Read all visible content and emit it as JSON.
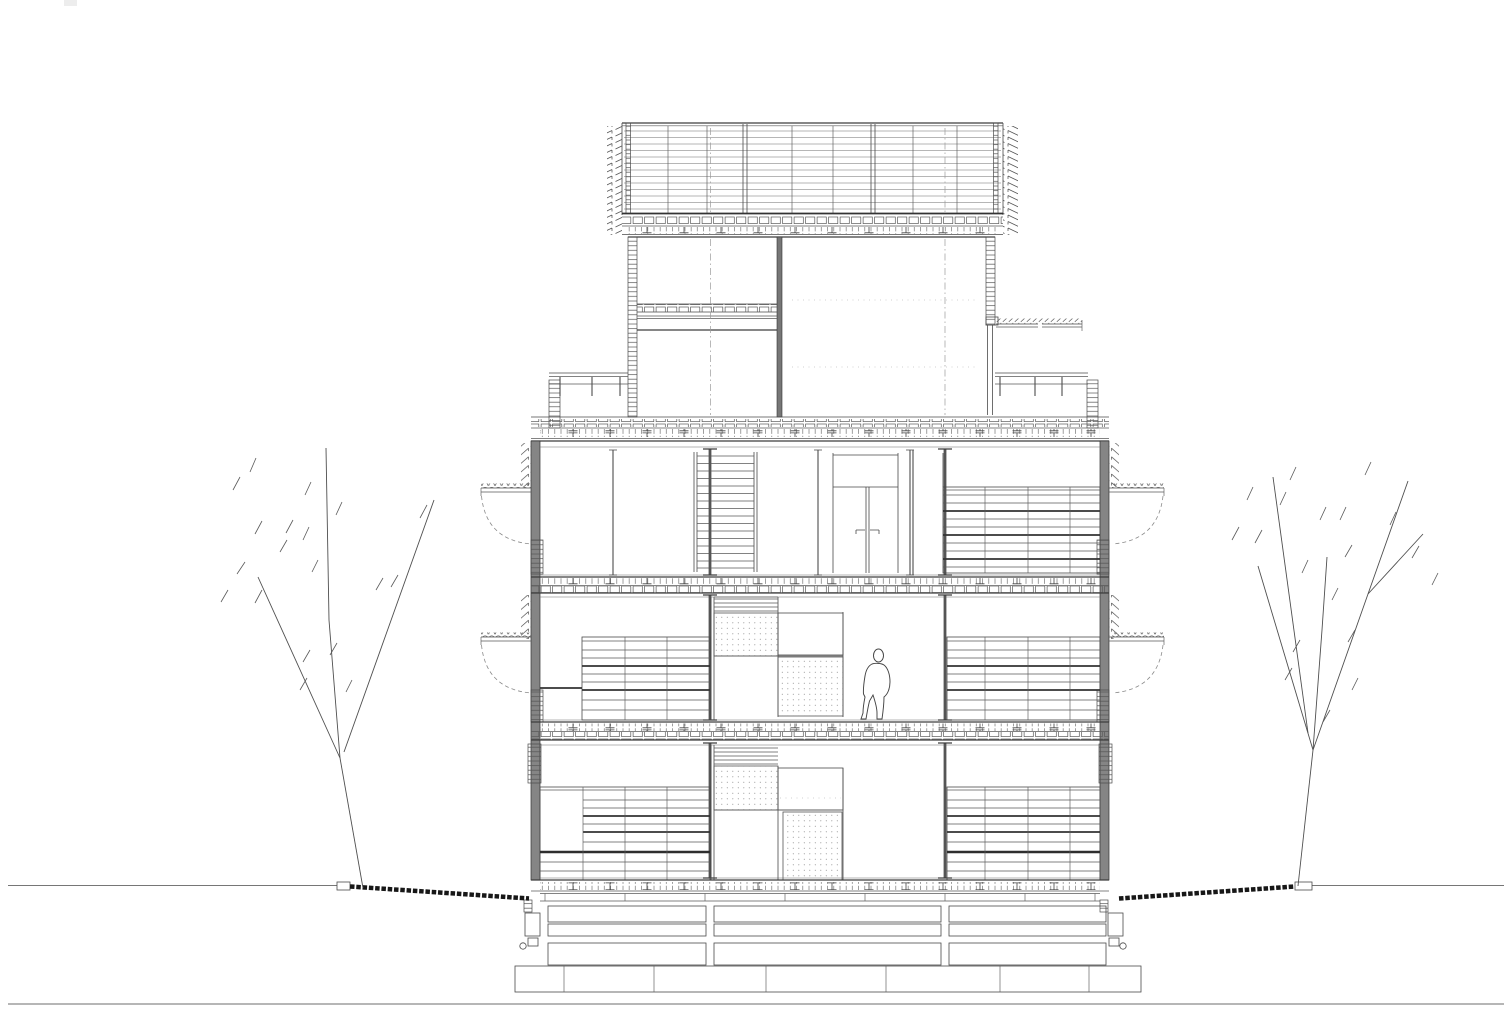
{
  "meta": {
    "title": "Building cross-section drawing",
    "description": "Black-and-white architectural cross-section of a multi-storey building: a louvered rooftop canopy above a set-back penthouse with roof terraces, three main floors with shelving grids, stairs, stippled insulation panels and a human scale figure, on a stepped foundation plinth, flanked by two bare trees on a ground line.",
    "canvas": {
      "width": 1512,
      "height": 1032
    },
    "background": "#ffffff"
  },
  "palette": {
    "line": "#4a4a4a",
    "line_light": "#6e6e6e",
    "wall_poche": "#858585",
    "ground_hatch": "#171717",
    "stipple_dot": "#8f8f8f",
    "centerline": "#9a9a9a"
  },
  "elements": {
    "canopy": "louvered rooftop canopy with slatted side fins",
    "penthouse": "penthouse level with window, blank wall and flanking roof terraces",
    "floor_3": "upper floor with stair shaft, double door and glazing-shelf grid",
    "floor_2": "middle floor with shelf grids, stippled panels and scale figure",
    "floor_1": "ground floor with shelf grids and stippled panels",
    "foundation": "stepped foundation plinth of stacked blocks",
    "ground": "ground line with dark hatched slopes and planters",
    "tree_left": "bare deciduous tree, left side",
    "tree_right": "bare deciduous tree, right side",
    "figure": "outline of a standing person for scale"
  }
}
